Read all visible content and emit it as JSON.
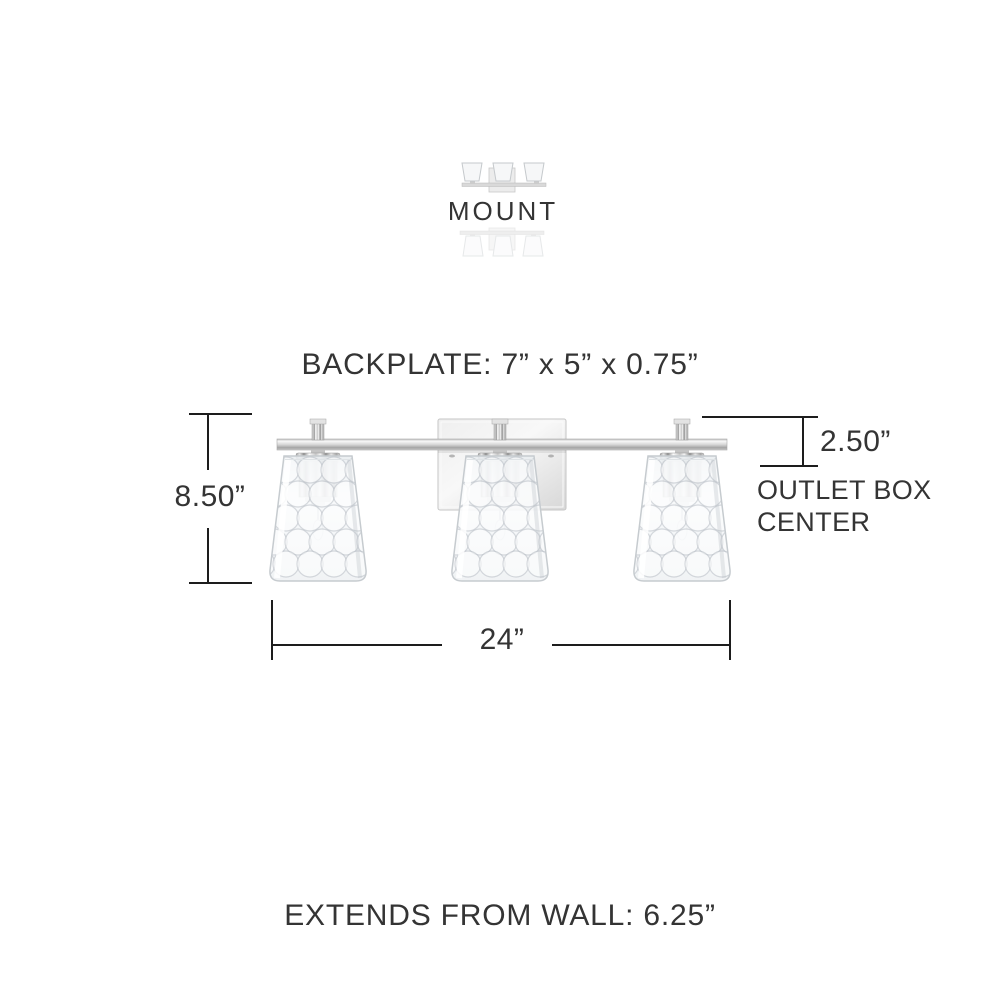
{
  "mount": {
    "label": "MOUNT"
  },
  "dimensions": {
    "backplate": "BACKPLATE: 7” x 5” x 0.75”",
    "fixture_height": "8.50”",
    "outlet_offset": "2.50”",
    "outlet_box_label": "OUTLET BOX\nCENTER",
    "fixture_width": "24”",
    "extends_from_wall": "EXTENDS FROM WALL: 6.25”"
  },
  "icons": {
    "mount_up": "vanity-light-shades-up-icon",
    "mount_down": "vanity-light-shades-down-icon"
  },
  "colors": {
    "background": "#ffffff",
    "text": "#343434",
    "dimension_line": "#1d1d1d",
    "chrome_light": "#f5f5f5",
    "chrome_dark": "#9a9a9a",
    "glass_tint": "#eef1f3"
  }
}
